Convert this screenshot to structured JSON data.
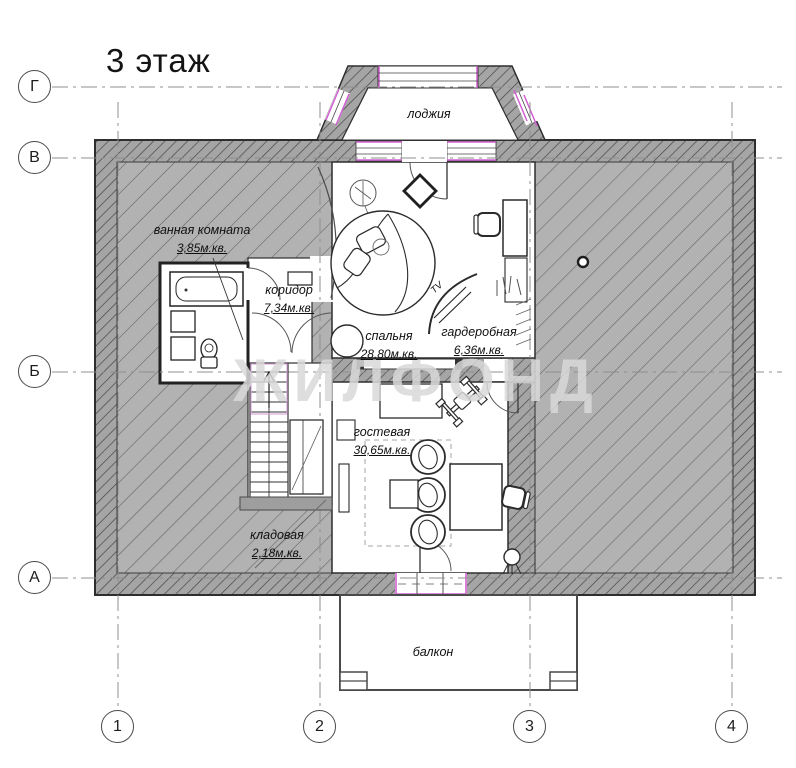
{
  "title": "3 этаж",
  "watermark": "ЖИЛФОНД",
  "axes": {
    "rows": [
      {
        "label": "Г"
      },
      {
        "label": "В"
      },
      {
        "label": "Б"
      },
      {
        "label": "А"
      }
    ],
    "cols": [
      {
        "label": "1"
      },
      {
        "label": "2"
      },
      {
        "label": "3"
      },
      {
        "label": "4"
      }
    ]
  },
  "rooms": [
    {
      "name": "лоджия",
      "area": ""
    },
    {
      "name": "ванная комната",
      "area": "3,85м.кв."
    },
    {
      "name": "коридор",
      "area": "7,34м.кв."
    },
    {
      "name": "спальня",
      "area": "28,80м.кв."
    },
    {
      "name": "гардеробная",
      "area": "6,36м.кв."
    },
    {
      "name": "гостевая",
      "area": "30,65м.кв."
    },
    {
      "name": "кладовая",
      "area": "2,18м.кв."
    },
    {
      "name": "балкон",
      "area": ""
    }
  ],
  "annotations": {
    "tv": "TV"
  },
  "colors": {
    "wall_hatch_fill": "#a5a5a5",
    "attic_hatch_fill": "#b2b2b2",
    "hatch_line": "#474747",
    "window_accent_magenta": "#d25fd2",
    "stair_accent_magenta": "#d9a8d9",
    "axis_line": "#8f8f8f",
    "outline": "#2e2e2e"
  }
}
